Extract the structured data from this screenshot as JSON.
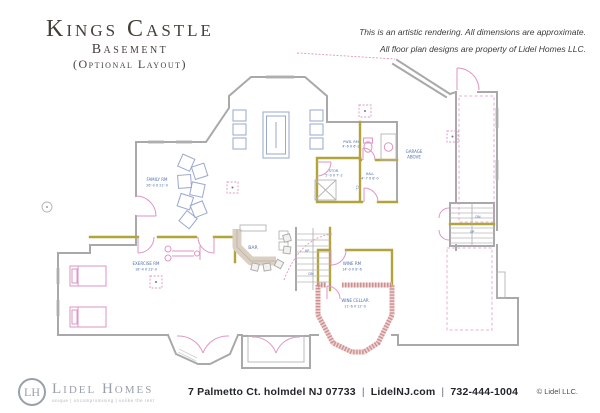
{
  "header": {
    "title": "Kings Castle",
    "subtitle": "Basement",
    "subtitle2": "(Optional Layout)",
    "disclaimer_line1": "This is an artistic rendering. All dimensions are approximate.",
    "disclaimer_line2": "All floor plan designs are property of Lidel Homes LLC."
  },
  "floor_plan": {
    "labels": {
      "family": {
        "name": "FAMILY RM",
        "dims": "26'-0 X 21'-0"
      },
      "bar": "BAR",
      "exercise": {
        "name": "EXERCISE RM",
        "dims": "18'-4 X 23'-0"
      },
      "powder": {
        "name": "PWD. RM",
        "dims": "4'-6 X 6'-2"
      },
      "storage": {
        "name": "STOR.",
        "dims": "5'-0 X 7'-2"
      },
      "hall": {
        "name": "HALL",
        "dims": "4'-7 X 8'-0"
      },
      "closet": "CL.",
      "garage": {
        "line1": "GARAGE",
        "line2": "ABOVE"
      },
      "wine_room": {
        "name": "WINE RM",
        "dims": "14'-0 X 8'-6"
      },
      "wine_cellar": {
        "name": "WINE CELLAR",
        "dims": "11'-6 X 12'-0"
      },
      "stair_up": "UP",
      "stair_dn": "DN",
      "stair2_up": "UP",
      "stair2_dn": "DN"
    }
  },
  "colors": {
    "wall": "#a9a9a9",
    "wall_accent": "#b3a33b",
    "door": "#de96c5",
    "brick": "#cf8f8f",
    "brick_light": "#ecd2d2",
    "label": "#4f6fae",
    "furniture": "#9ba7cd",
    "counter": "#d9cfc3",
    "title": "#453f39",
    "footer_text": "#23252c",
    "logo": "#99a0ac"
  },
  "footer": {
    "monogram": "LH",
    "brand": "Lidel Homes",
    "tagline": "unique  |  uncompromising  |  unlike the rest",
    "address": "7 Palmetto Ct. holmdel NJ 07733",
    "site": "LidelNJ.com",
    "phone": "732-444-1004",
    "sep": "|",
    "copyright": "© Lidel LLC."
  }
}
